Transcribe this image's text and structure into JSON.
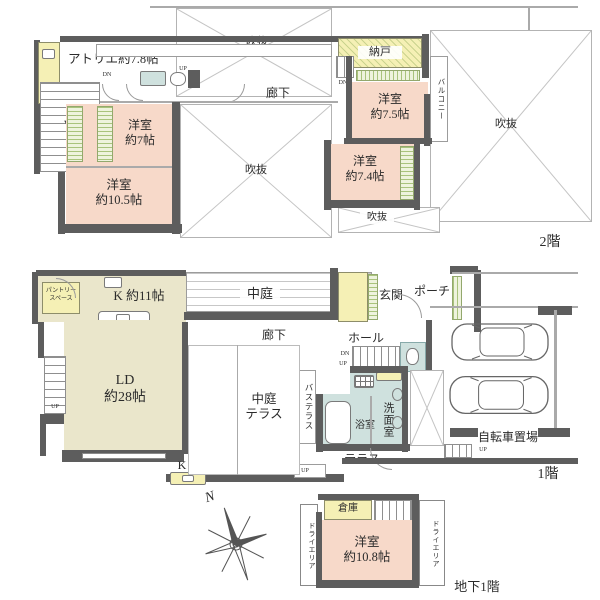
{
  "meta": {
    "kind": "japanese-residential-floor-plan",
    "floors_shown": 3
  },
  "colors": {
    "room_pink": "#f7d9c9",
    "room_cream": "#eae6cb",
    "accent_yellow": "#f5f0b5",
    "water_blue": "#cfe1de",
    "wall_gray": "#5d5d5d"
  },
  "common": {
    "void": "吹抜",
    "corridor": "廊下",
    "up": "UP",
    "down": "DN",
    "arrow_down": "▼"
  },
  "floor2": {
    "label": "2階",
    "atelier": "アトリエ約7.8帖",
    "storeroom": "納戸",
    "bedroom_7_5": "洋室\n約7.5帖",
    "balcony": "バルコニー",
    "bedroom_7": "洋室\n約7帖",
    "bedroom_7_4": "洋室\n約7.4帖",
    "bedroom_10_5": "洋室\n約10.5帖"
  },
  "floor1": {
    "label": "1階",
    "kitchen": "K 約11帖",
    "pantry": "パントリー\nスペース",
    "courtyard": "中庭",
    "entrance": "玄関",
    "porch": "ポーチ",
    "hall": "ホール",
    "living": "LD\n約28帖",
    "courtyard_terrace": "中庭\nテラス",
    "bath_terrace": "バステラス",
    "bathroom": "浴室",
    "washroom": "洗面室",
    "terrace": "テラス",
    "bicycle_parking": "自転車置場",
    "kitchen_counter": "K"
  },
  "basement": {
    "label": "地下1階",
    "storage": "倉庫",
    "bedroom_10_8": "洋室\n約10.8帖",
    "dry_area": "ドライエリア",
    "compass_north": "N"
  }
}
